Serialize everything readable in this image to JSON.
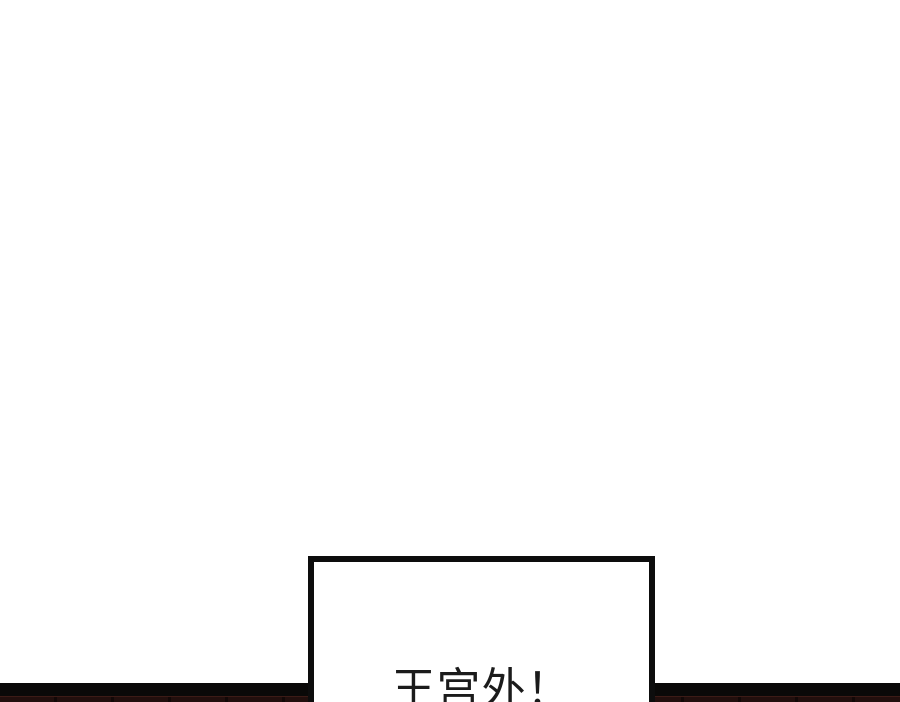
{
  "comic": {
    "caption": {
      "text": "王宫外！"
    },
    "colors": {
      "background": "#ffffff",
      "panel_border": "#0d0d0d",
      "gutter_bar": "#0a0908",
      "next_panel_sliver": "#220f0d",
      "next_panel_seam": "#120807",
      "next_panel_sliver_highlight": "#3c1b16",
      "caption_text": "#1b1b1b"
    }
  }
}
